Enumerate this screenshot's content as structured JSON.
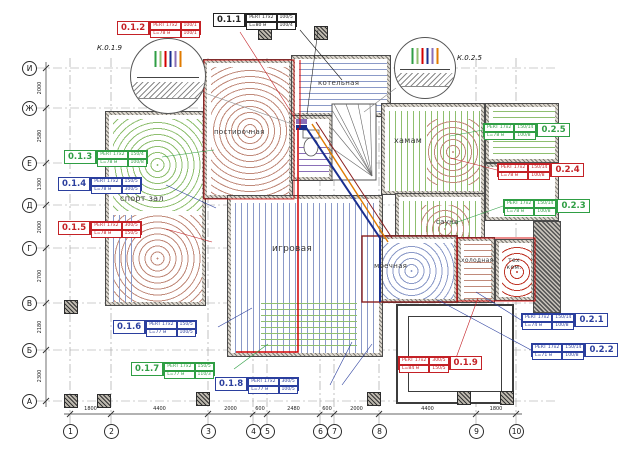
{
  "drawing": {
    "axes_bottom": {
      "labels": [
        "1",
        "2",
        "3",
        "4",
        "5",
        "6",
        "7",
        "8",
        "9",
        "10"
      ],
      "dims": [
        "1800",
        "4400",
        "2000",
        "600",
        "2480",
        "600",
        "2000",
        "4400",
        "1800"
      ]
    },
    "axes_left": {
      "labels": [
        "И",
        "Ж",
        "Е",
        "Д",
        "Г",
        "В",
        "Б",
        "А"
      ],
      "dims": [
        "2000",
        "2580",
        "1300",
        "2000",
        "2700",
        "2180",
        "2300"
      ]
    },
    "details": [
      {
        "label": "К.0.1.9"
      },
      {
        "label": "К.0.2.5"
      }
    ],
    "rooms": {
      "sport_hall": "спорт зал",
      "laundry": "постирочная",
      "boiler": "котельная",
      "hamam": "хамам",
      "sauna": "сауна",
      "washing": "моечная",
      "cold": "холодная",
      "tech": "тех ком.",
      "playroom": "игровая"
    },
    "tags": [
      {
        "id": "0.1.1",
        "pipe": "PERT 17x2",
        "len": "L=80 м",
        "v1": "100/5",
        "v2": "100/4"
      },
      {
        "id": "0.1.2",
        "pipe": "PERT 17x2",
        "len": "L=78 м",
        "v1": "100/1",
        "v2": "100/1"
      },
      {
        "id": "0.1.3",
        "pipe": "PERT 17x2",
        "len": "L=78 м",
        "v1": "150/4",
        "v2": "100/8"
      },
      {
        "id": "0.1.4",
        "pipe": "PERT 17x2",
        "len": "L=78 м",
        "v1": "150/5",
        "v2": "300/5"
      },
      {
        "id": "0.1.5",
        "pipe": "PERT 17x2",
        "len": "L=78 м",
        "v1": "300/5",
        "v2": "150/5"
      },
      {
        "id": "0.1.6",
        "pipe": "PERT 17x2",
        "len": "L=77 м",
        "v1": "150/5",
        "v2": "100/5"
      },
      {
        "id": "0.1.7",
        "pipe": "PERT 17x2",
        "len": "L=77 м",
        "v1": "150/5",
        "v2": "110/3"
      },
      {
        "id": "0.1.8",
        "pipe": "PERT 17x2",
        "len": "L=77 м",
        "v1": "300/5",
        "v2": "100/5"
      },
      {
        "id": "0.1.9",
        "pipe": "PERT 17x2",
        "len": "L=84 м",
        "v1": "300/5",
        "v2": "150/5"
      },
      {
        "id": "0.2.1",
        "pipe": "PERT 17x2",
        "len": "L=74 м",
        "v1": "150/14",
        "v2": "100/8"
      },
      {
        "id": "0.2.2",
        "pipe": "PERT 17x2",
        "len": "L=71 м",
        "v1": "150/14",
        "v2": "100/8"
      },
      {
        "id": "0.2.3",
        "pipe": "PERT 17x2",
        "len": "L=78 м",
        "v1": "150/14",
        "v2": "100/8"
      },
      {
        "id": "0.2.4",
        "pipe": "PERT 17x2",
        "len": "L=78 м",
        "v1": "150/14",
        "v2": "100/8"
      },
      {
        "id": "0.2.5",
        "pipe": "PERT 17x2",
        "len": "L=78 м",
        "v1": "150/14",
        "v2": "100/8"
      }
    ],
    "colors": {
      "red": "#c42126",
      "red2": "#c0392b",
      "green": "#2f9e44",
      "blue": "#2b3f9e",
      "dark": "#222222",
      "dim": "#888888",
      "pipe_red": "#d40000",
      "pipe_navy": "#1a2f8f",
      "pipe_orange": "#e07b00",
      "pipe_maroon": "#8a1f1f",
      "loop_green": "#8fbf6f",
      "loop_red": "#c08a7a",
      "loop_blue": "#8b9ac8",
      "loop_purple": "#8a6fb8"
    }
  }
}
